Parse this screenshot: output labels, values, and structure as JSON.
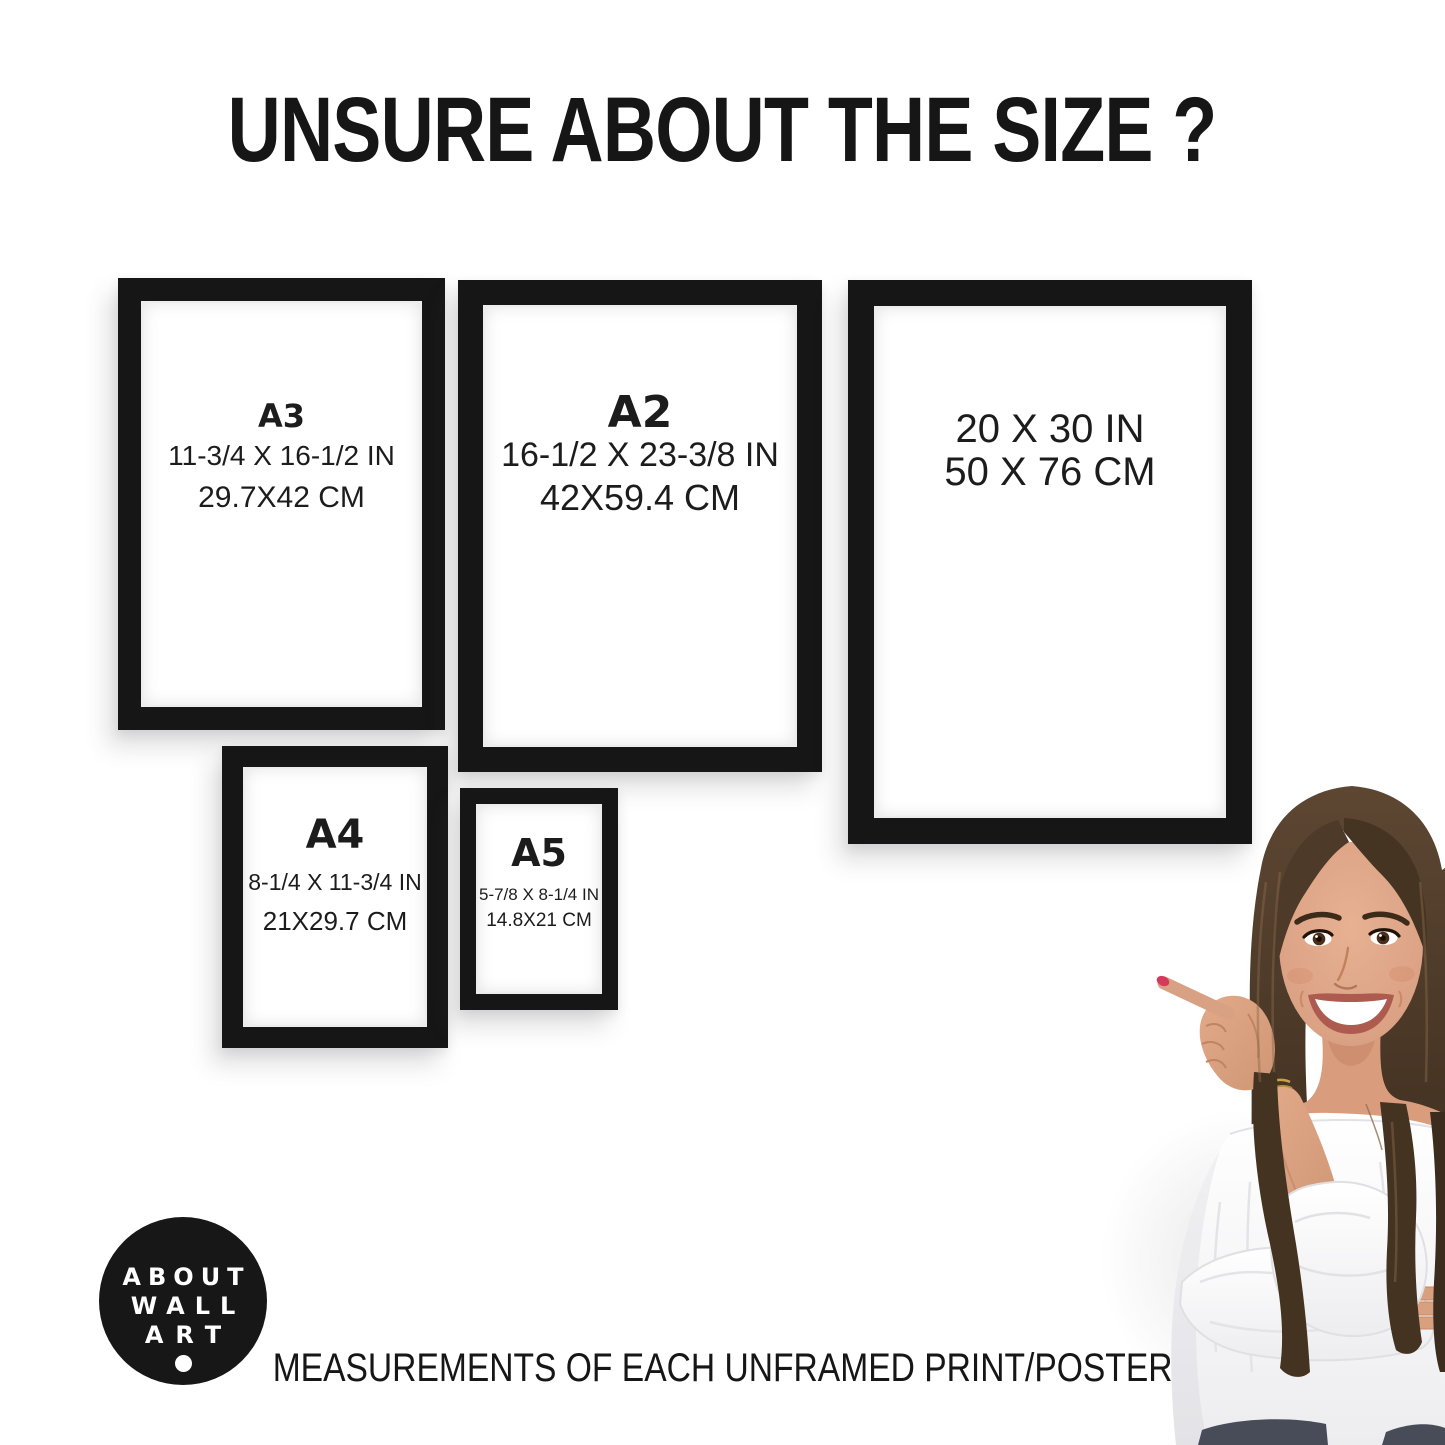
{
  "title": "UNSURE ABOUT THE SIZE ?",
  "caption": "MEASUREMENTS OF EACH UNFRAMED PRINT/POSTER",
  "logo": {
    "line1": "ABOUT",
    "line2": "WALL",
    "line3": "ART"
  },
  "frames": [
    {
      "label": "A3",
      "inches": "11-3/4 X 16-1/2 IN",
      "cm": "29.7X42 CM"
    },
    {
      "label": "A2",
      "inches": "16-1/2 X 23-3/8 IN",
      "cm": "42X59.4 CM"
    },
    {
      "label": "",
      "inches": "20 X 30 IN",
      "cm": "50 X 76 CM"
    },
    {
      "label": "A4",
      "inches": "8-1/4 X 11-3/4 IN",
      "cm": "21X29.7 CM"
    },
    {
      "label": "A5",
      "inches": "5-7/8 X 8-1/4 IN",
      "cm": "14.8X21 CM"
    }
  ],
  "colors": {
    "background": "#ffffff",
    "frame": "#161616",
    "text": "#1c1c1c",
    "logo_background": "#171717",
    "logo_text": "#ffffff",
    "nail_polish": "#d63a5b",
    "hair": "#4a3726",
    "skin": "#dba184",
    "blouse": "#f8f8f9"
  }
}
